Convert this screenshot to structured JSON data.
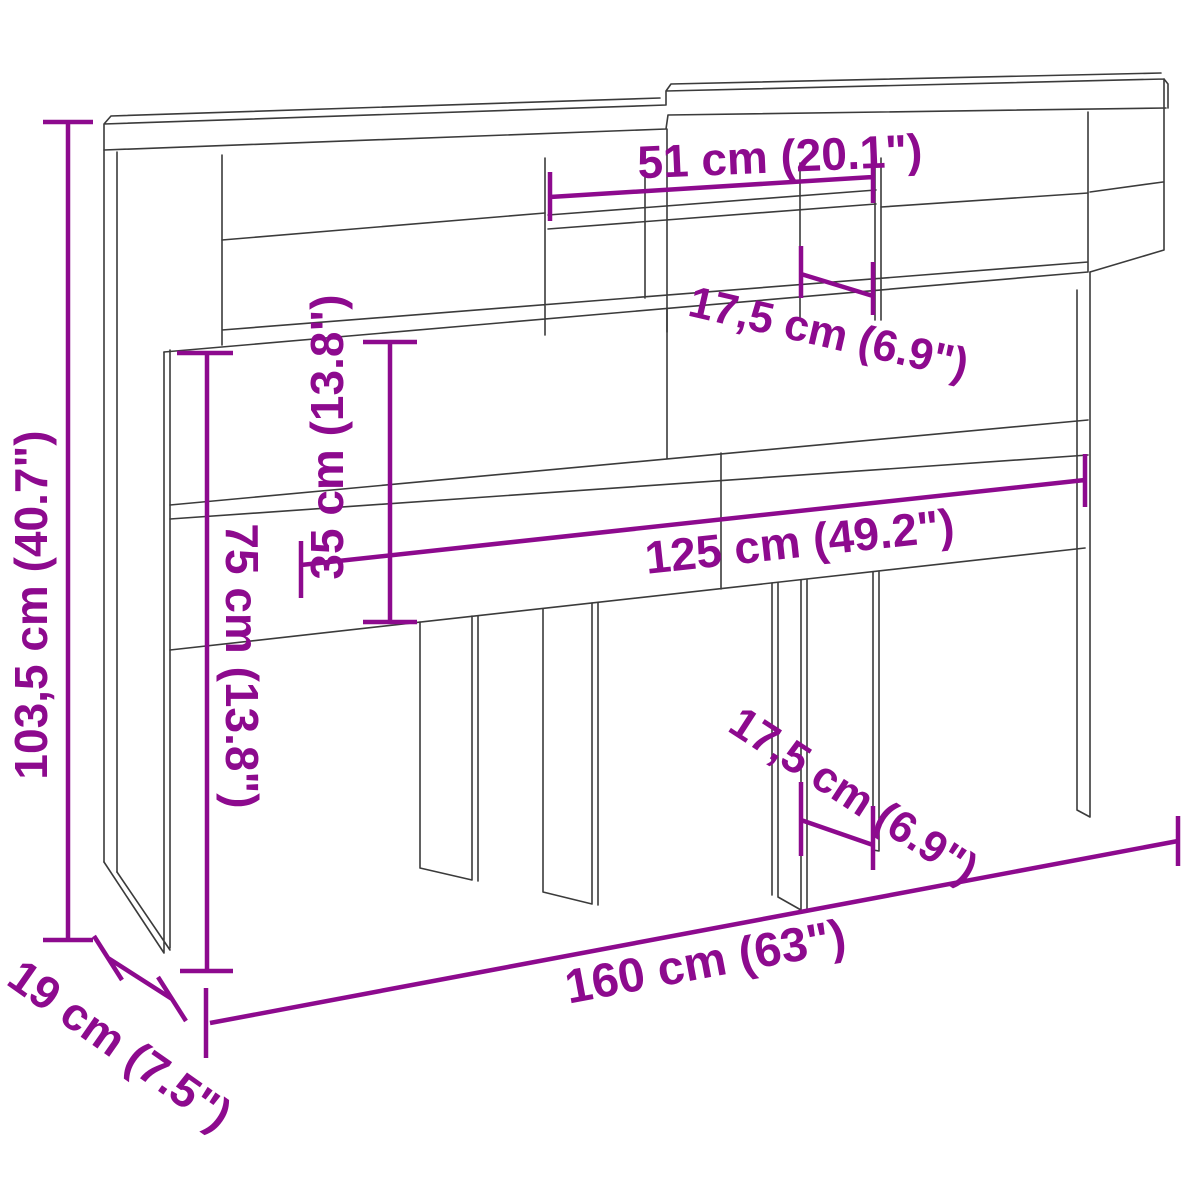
{
  "diagram": {
    "type": "furniture-dimension-diagram",
    "product": "headboard-cabinet-with-shelves",
    "background_color": "#ffffff",
    "dimension_color": "#8D0A8E",
    "outline_color": "#3b3b3b",
    "dimensions": {
      "overall_height": "103,5 cm (40.7\")",
      "shelf_opening_width": "51 cm (20.1\")",
      "top_compartment_width": "17,5 cm (6.9\")",
      "hutch_inner_height": "35 cm (13.8\")",
      "panel_height": "75 cm (13.8\")",
      "inner_width": "125 cm (49.2\")",
      "support_gap": "17,5 cm (6.9\")",
      "overall_width": "160 cm (63\")",
      "depth": "19 cm (7.5\")"
    }
  }
}
